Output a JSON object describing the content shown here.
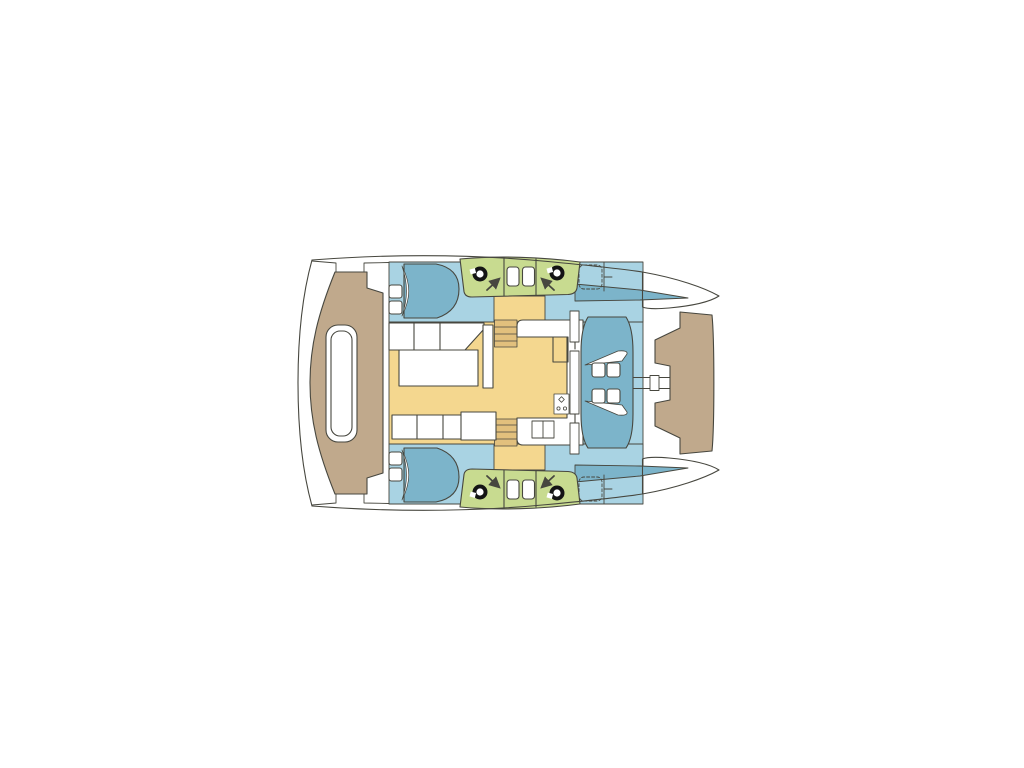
{
  "scene": {
    "label": "Catamaran deck floor plan, top-down view, bow to the right",
    "kind": "boat-floor-plan"
  },
  "colors": {
    "background": "#ffffff",
    "outline": "#47473f",
    "deck_tan": "#c0a98c",
    "interior_blue": "#a9d3e3",
    "furniture_blue": "#7cb4ca",
    "salon_yellow": "#f4d78f",
    "steps_tan": "#e2c07d",
    "pod_green": "#c8db90",
    "fixture_white": "#ffffff",
    "winch_black": "#141414"
  },
  "legend": {
    "deck_tan": "exterior decks (aft platform, foredeck)",
    "interior_blue": "hull interior and forward cockpit floor",
    "furniture_blue": "berths, tapered side decks, cockpit bench unit",
    "salon_yellow": "saloon and galley sole",
    "pod_green": "winch / hatch deck pods",
    "fixture_white": "furniture, walkways, trampoline gaps"
  },
  "features": {
    "double_berths": 2,
    "berth_pillows": 4,
    "deck_hatches": 4,
    "winches": 4,
    "direction_arrows": 4,
    "cockpit_seats": 4,
    "cockpit_tables": 2,
    "companionway_stairways": 2,
    "sun_pad": 1,
    "galley_sink_basins": 2,
    "stove": 1
  }
}
